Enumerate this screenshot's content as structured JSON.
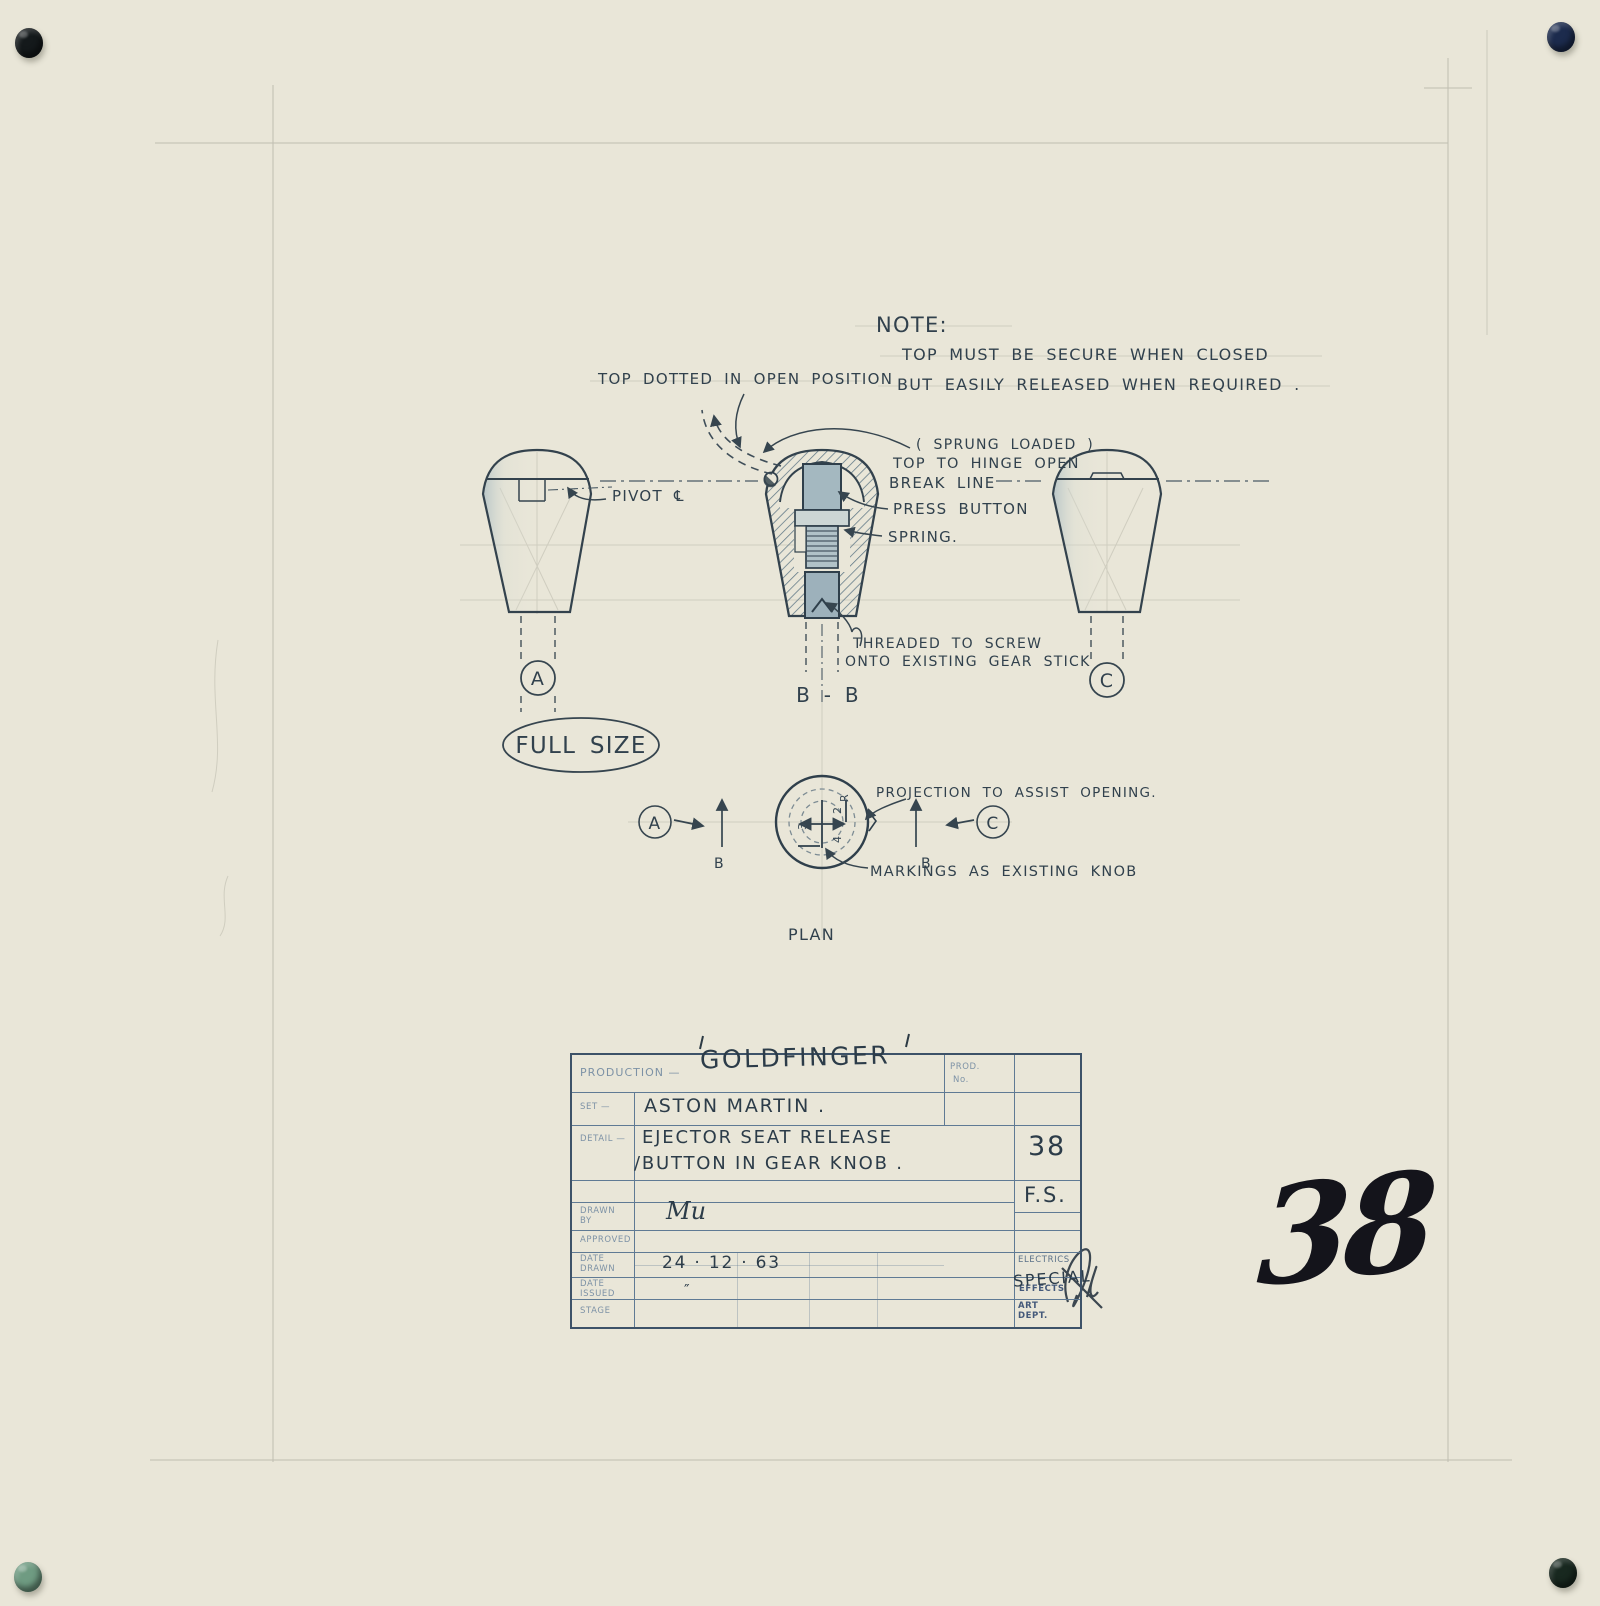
{
  "colors": {
    "paper": "#e9e6d8",
    "ink": "#36454f",
    "pencil": "#8e8e82",
    "form_blue": "#5f7a94"
  },
  "pins": {
    "top_left": "#14191b",
    "top_right": "#1c2b4d",
    "bottom_left": "#6f9b82",
    "bottom_right": "#18281f"
  },
  "note": {
    "title": "NOTE:",
    "line1": "TOP MUST BE SECURE WHEN CLOSED",
    "line2": "BUT EASILY RELEASED WHEN REQUIRED ."
  },
  "annotations": {
    "top_dotted": "TOP DOTTED IN OPEN POSITION",
    "pivot": "PIVOT ℄",
    "sprung_loaded": "( SPRUNG LOADED )",
    "hinge_open": "TOP TO HINGE OPEN",
    "break_line": "BREAK LINE",
    "press_button": "PRESS BUTTON",
    "spring": "SPRING.",
    "threaded_1": "THREADED TO SCREW",
    "threaded_2": "ONTO EXISTING GEAR STICK",
    "projection": "PROJECTION TO ASSIST OPENING.",
    "markings": "MARKINGS AS EXISTING KNOB",
    "full_size": "FULL SIZE",
    "plan": "PLAN"
  },
  "views": {
    "a": "A",
    "bb": "B - B",
    "c": "C",
    "plan_a": "A",
    "plan_b_left": "B",
    "plan_b_right": "B",
    "plan_c": "C",
    "gear_marks": {
      "left": "3",
      "right_top": "2",
      "right_bottom": "4",
      "reverse": "R"
    }
  },
  "title_block": {
    "production_label": "PRODUCTION —",
    "production_value": "GOLDFINGER",
    "prod_no_label_1": "PROD.",
    "prod_no_label_2": "No.",
    "set_label": "SET —",
    "set_value": "ASTON MARTIN .",
    "detail_label": "DETAIL —",
    "detail_line1": "EJECTOR SEAT RELEASE",
    "detail_line2": "/BUTTON IN GEAR KNOB .",
    "sheet_no": "38",
    "scale": "F.S.",
    "drawn_label": "DRAWN BY",
    "drawn_value": "Mu",
    "approved_label": "APPROVED",
    "date_drawn_label": "DATE DRAWN",
    "date_drawn_value": "24 · 12 · 63",
    "date_issued_label": "DATE ISSUED",
    "date_issued_value": "″",
    "stage_label": "STAGE",
    "dept_electrics": "ELECTRICS",
    "dept_effects_printed": "EFFECTS",
    "dept_effects_handwritten": "SPECIAL",
    "dept_art": "ART DEPT."
  },
  "sheet_number_large": "38"
}
